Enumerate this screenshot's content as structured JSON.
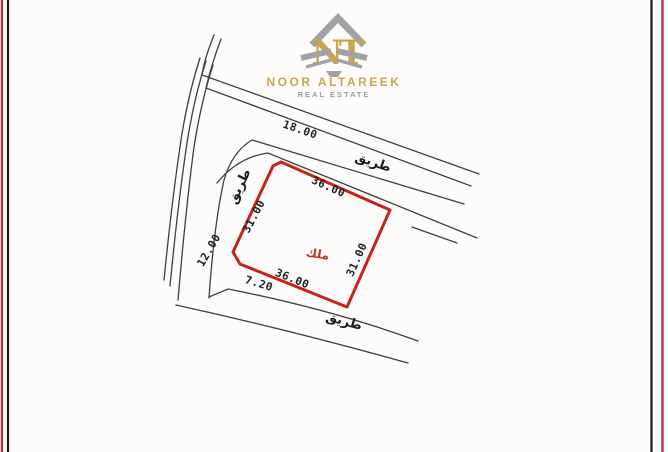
{
  "brand": {
    "monogram": "NT",
    "name": "NOOR ALTAREEK",
    "tagline": "REAL ESTATE",
    "gold": "#c9a54f",
    "gray": "#9c9c9c"
  },
  "frame": {
    "outer_color": "#b13349",
    "inner_color": "#1b1b1b"
  },
  "plan": {
    "owner_label": "ملك",
    "road_label_top": "طريق",
    "road_label_left": "طريق",
    "road_label_bottom": "طريق",
    "dimensions": {
      "top_road": "18.00",
      "plot_top": "36.00",
      "plot_bottom": "36.00",
      "plot_left": "31.00",
      "plot_right": "31.00",
      "left_road": "12.00",
      "corner_offset": "7.20"
    },
    "colors": {
      "plot_outline": "#c5231c",
      "road_line": "#3f3f3f",
      "owner_text": "#bf3226"
    }
  }
}
